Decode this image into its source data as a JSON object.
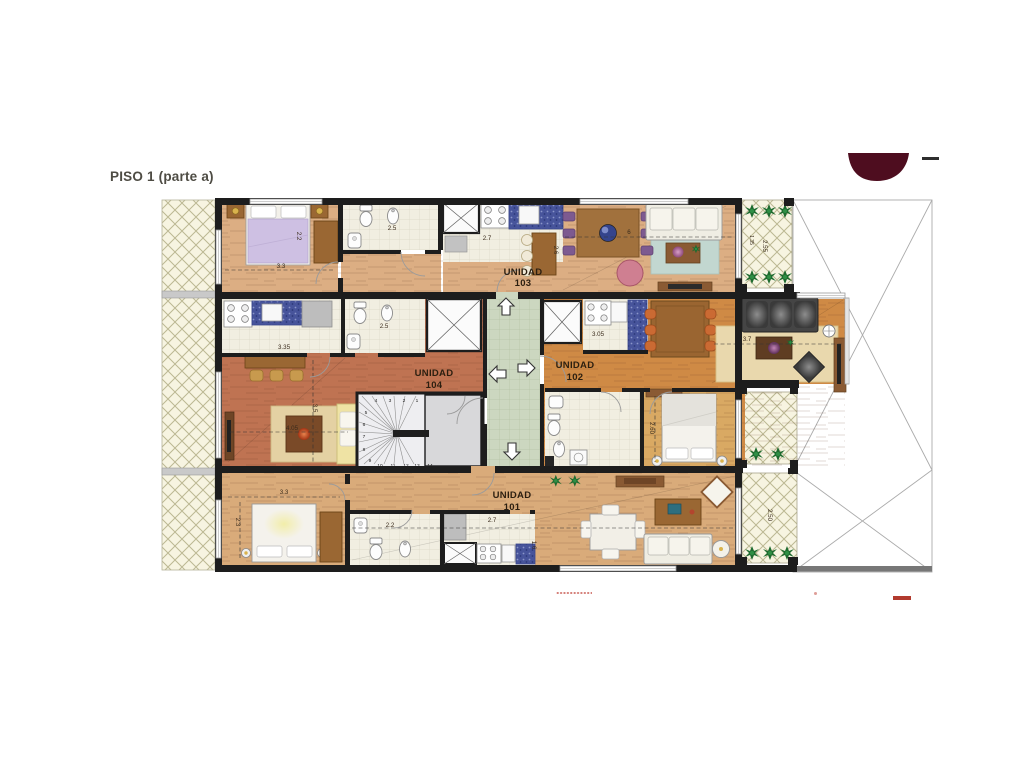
{
  "page": {
    "title": "PISO 1 (parte a)"
  },
  "units": [
    {
      "name": "UNIDAD",
      "number": "103"
    },
    {
      "name": "UNIDAD",
      "number": "104"
    },
    {
      "name": "UNIDAD",
      "number": "102"
    },
    {
      "name": "UNIDAD",
      "number": "101"
    }
  ],
  "dimensions": {
    "b103_width": "2.2",
    "b103_len": "3.3",
    "bath103": "2.5",
    "kit103": "2.7",
    "liv103_len": "6",
    "liv103_w": "2.6",
    "kit104": "3.35",
    "bath104": "2.5",
    "liv104_len": "4.05",
    "liv104_w": "3.5",
    "kit102": "3.05",
    "liv102": "3.7",
    "bed102": "2.60",
    "bed101_len": "3.3",
    "bed101_w": "2.3",
    "bath101": "2.2",
    "kit101": "2.7",
    "kit101_w": "1.6",
    "balc_top_len": "2.55",
    "balc_top_w": "1.35",
    "balc_bot": "2.50"
  },
  "stairs": {
    "steps": [
      "1",
      "2",
      "3",
      "4",
      "5",
      "6",
      "7",
      "8",
      "9",
      "10",
      "11",
      "12",
      "13",
      "14"
    ]
  },
  "palette": {
    "wall": "#1d1d1d",
    "hallway_floor": "#ccd7c0",
    "balcony_floor": "#f7f4e1",
    "wood_light": "#dcae83",
    "wood_red": "#bf7352",
    "wood_orange": "#cf8a45",
    "counter_blue": "#47549b",
    "logo": "#4e0d1f"
  }
}
